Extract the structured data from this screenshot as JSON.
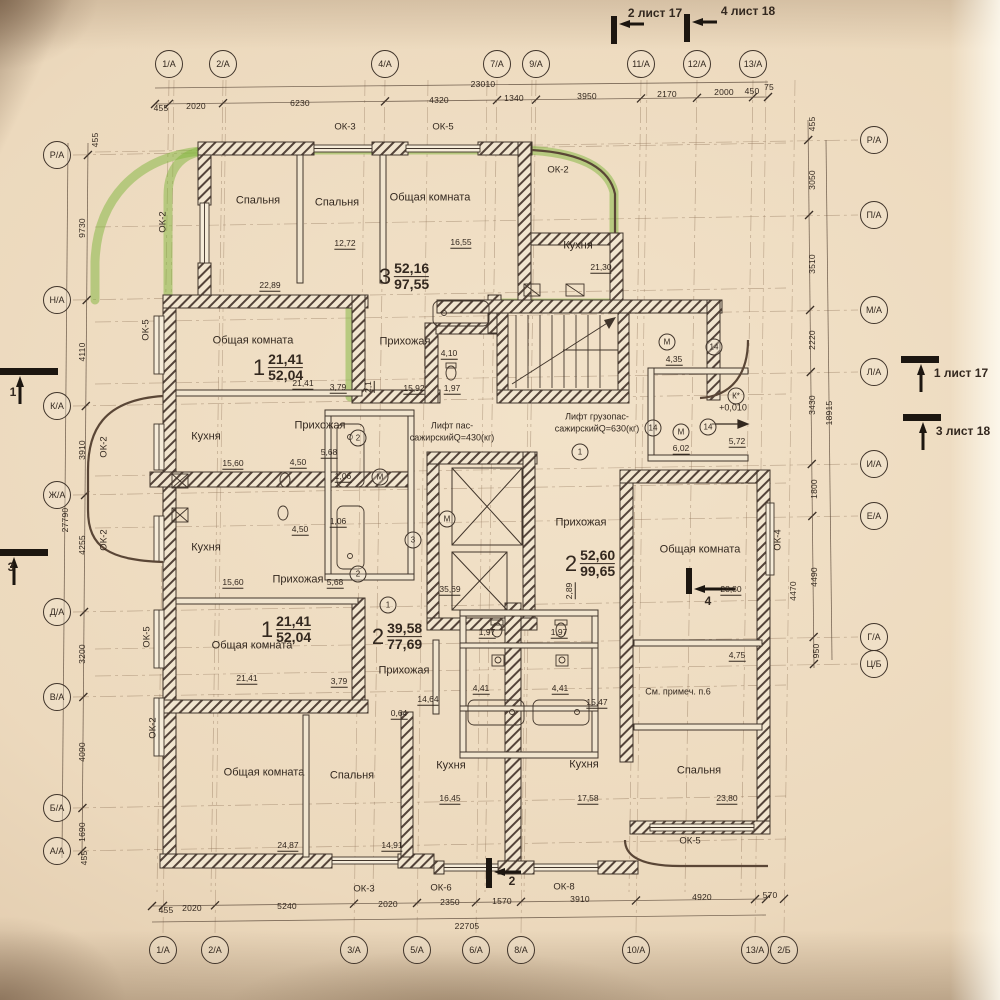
{
  "colors": {
    "paper": "#ecd9bf",
    "ink": "#3b2f26",
    "wall_hatch": "#54443a",
    "highlight_green": "#7fb63b"
  },
  "sheet_markers": {
    "top": [
      {
        "t": "2 лист 17",
        "x": 655,
        "y": 13
      },
      {
        "t": "4 лист 18",
        "x": 748,
        "y": 11
      }
    ],
    "right": [
      {
        "t": "1 лист 17",
        "x": 961,
        "y": 373
      },
      {
        "t": "3 лист 18",
        "x": 963,
        "y": 431
      }
    ],
    "left": [
      {
        "t": "1",
        "x": 13,
        "y": 392
      },
      {
        "t": "3",
        "x": 11,
        "y": 567
      }
    ],
    "bottom": [
      {
        "t": "2",
        "x": 512,
        "y": 881
      }
    ],
    "section": [
      {
        "t": "4",
        "x": 708,
        "y": 601
      }
    ]
  },
  "axes": {
    "top": [
      {
        "label": "1/А",
        "x": 169
      },
      {
        "label": "2/А",
        "x": 223
      },
      {
        "label": "4/А",
        "x": 385
      },
      {
        "label": "7/А",
        "x": 497
      },
      {
        "label": "9/А",
        "x": 536
      },
      {
        "label": "11/А",
        "x": 641
      },
      {
        "label": "12/А",
        "x": 697
      },
      {
        "label": "13/А",
        "x": 753
      }
    ],
    "bottom": [
      {
        "label": "1/А",
        "x": 163
      },
      {
        "label": "2/А",
        "x": 215
      },
      {
        "label": "3/А",
        "x": 354
      },
      {
        "label": "5/А",
        "x": 417
      },
      {
        "label": "6/А",
        "x": 476
      },
      {
        "label": "8/А",
        "x": 521
      },
      {
        "label": "10/А",
        "x": 636
      },
      {
        "label": "13/А",
        "x": 755
      },
      {
        "label": "2/Б",
        "x": 784
      }
    ],
    "left": [
      {
        "label": "Р/А",
        "y": 155
      },
      {
        "label": "Н/А",
        "y": 300
      },
      {
        "label": "К/А",
        "y": 406
      },
      {
        "label": "Ж/А",
        "y": 495
      },
      {
        "label": "Д/А",
        "y": 612
      },
      {
        "label": "В/А",
        "y": 697
      },
      {
        "label": "Б/А",
        "y": 808
      },
      {
        "label": "А/А",
        "y": 851
      }
    ],
    "right": [
      {
        "label": "Р/А",
        "y": 140
      },
      {
        "label": "П/А",
        "y": 215
      },
      {
        "label": "М/А",
        "y": 310
      },
      {
        "label": "Л/А",
        "y": 372
      },
      {
        "label": "И/А",
        "y": 464
      },
      {
        "label": "Е/А",
        "y": 516
      },
      {
        "label": "Г/А",
        "y": 637
      },
      {
        "label": "Ц/Б",
        "y": 664
      }
    ]
  },
  "dim_labels": [
    {
      "t": "455",
      "x": 161,
      "y": 108
    },
    {
      "t": "2020",
      "x": 196,
      "y": 106
    },
    {
      "t": "6230",
      "x": 300,
      "y": 103
    },
    {
      "t": "4320",
      "x": 439,
      "y": 100
    },
    {
      "t": "1340",
      "x": 514,
      "y": 98
    },
    {
      "t": "3950",
      "x": 587,
      "y": 96
    },
    {
      "t": "2170",
      "x": 667,
      "y": 94
    },
    {
      "t": "2000",
      "x": 724,
      "y": 92
    },
    {
      "t": "450",
      "x": 752,
      "y": 91
    },
    {
      "t": "75",
      "x": 769,
      "y": 87
    },
    {
      "t": "23010",
      "x": 483,
      "y": 84
    },
    {
      "t": "455",
      "x": 166,
      "y": 910
    },
    {
      "t": "2020",
      "x": 192,
      "y": 908
    },
    {
      "t": "5240",
      "x": 287,
      "y": 906
    },
    {
      "t": "2020",
      "x": 388,
      "y": 904
    },
    {
      "t": "2350",
      "x": 450,
      "y": 902
    },
    {
      "t": "1570",
      "x": 502,
      "y": 901
    },
    {
      "t": "3910",
      "x": 580,
      "y": 899
    },
    {
      "t": "4920",
      "x": 702,
      "y": 897
    },
    {
      "t": "570",
      "x": 770,
      "y": 895
    },
    {
      "t": "22705",
      "x": 467,
      "y": 926
    },
    {
      "t": "455",
      "x": 95,
      "y": 140,
      "r": 1
    },
    {
      "t": "9730",
      "x": 82,
      "y": 228,
      "r": 1
    },
    {
      "t": "4110",
      "x": 82,
      "y": 352,
      "r": 1
    },
    {
      "t": "3910",
      "x": 82,
      "y": 450,
      "r": 1
    },
    {
      "t": "27790",
      "x": 65,
      "y": 520,
      "r": 1
    },
    {
      "t": "4255",
      "x": 82,
      "y": 545,
      "r": 1
    },
    {
      "t": "3200",
      "x": 82,
      "y": 654,
      "r": 1
    },
    {
      "t": "4090",
      "x": 82,
      "y": 752,
      "r": 1
    },
    {
      "t": "1690",
      "x": 82,
      "y": 832,
      "r": 1
    },
    {
      "t": "455",
      "x": 84,
      "y": 858,
      "r": 1
    },
    {
      "t": "455",
      "x": 812,
      "y": 124,
      "r": 1
    },
    {
      "t": "3050",
      "x": 812,
      "y": 180,
      "r": 1
    },
    {
      "t": "3510",
      "x": 812,
      "y": 264,
      "r": 1
    },
    {
      "t": "2220",
      "x": 812,
      "y": 340,
      "r": 1
    },
    {
      "t": "3430",
      "x": 812,
      "y": 405,
      "r": 1
    },
    {
      "t": "18915",
      "x": 829,
      "y": 413,
      "r": 1
    },
    {
      "t": "1800",
      "x": 814,
      "y": 489,
      "r": 1
    },
    {
      "t": "4490",
      "x": 814,
      "y": 577,
      "r": 1
    },
    {
      "t": "950",
      "x": 816,
      "y": 651,
      "r": 1
    },
    {
      "t": "4470",
      "x": 793,
      "y": 591,
      "r": 1
    }
  ],
  "room_labels": [
    {
      "t": "Спальня",
      "x": 258,
      "y": 201
    },
    {
      "t": "Спальня",
      "x": 337,
      "y": 203
    },
    {
      "t": "Общая комната",
      "x": 430,
      "y": 198
    },
    {
      "t": "Кухня",
      "x": 578,
      "y": 246
    },
    {
      "t": "Общая комната",
      "x": 253,
      "y": 341
    },
    {
      "t": "Прихожая",
      "x": 405,
      "y": 342
    },
    {
      "t": "Кухня",
      "x": 206,
      "y": 437
    },
    {
      "t": "Прихожая",
      "x": 320,
      "y": 426
    },
    {
      "t": "Кухня",
      "x": 206,
      "y": 548
    },
    {
      "t": "Прихожая",
      "x": 298,
      "y": 580
    },
    {
      "t": "Общая комната",
      "x": 252,
      "y": 646
    },
    {
      "t": "Прихожая",
      "x": 404,
      "y": 671
    },
    {
      "t": "Прихожая",
      "x": 581,
      "y": 523
    },
    {
      "t": "Общая комната",
      "x": 700,
      "y": 550
    },
    {
      "t": "Общая комната",
      "x": 264,
      "y": 773
    },
    {
      "t": "Спальня",
      "x": 352,
      "y": 776
    },
    {
      "t": "Кухня",
      "x": 451,
      "y": 766
    },
    {
      "t": "Кухня",
      "x": 584,
      "y": 765
    },
    {
      "t": "Спальня",
      "x": 699,
      "y": 771
    }
  ],
  "area_labels": [
    {
      "t": "22,89",
      "x": 270,
      "y": 286
    },
    {
      "t": "12,72",
      "x": 345,
      "y": 244
    },
    {
      "t": "16,55",
      "x": 461,
      "y": 243
    },
    {
      "t": "21,30",
      "x": 601,
      "y": 268
    },
    {
      "t": "21,41",
      "x": 303,
      "y": 384
    },
    {
      "t": "3,79",
      "x": 338,
      "y": 388
    },
    {
      "t": "2,1",
      "x": 369,
      "y": 387,
      "r": 1
    },
    {
      "t": "4,10",
      "x": 449,
      "y": 354
    },
    {
      "t": "15,92",
      "x": 414,
      "y": 389
    },
    {
      "t": "1,97",
      "x": 452,
      "y": 389
    },
    {
      "t": "15,60",
      "x": 233,
      "y": 464
    },
    {
      "t": "4,50",
      "x": 298,
      "y": 463
    },
    {
      "t": "5,68",
      "x": 329,
      "y": 453
    },
    {
      "t": "1,06",
      "x": 343,
      "y": 477
    },
    {
      "t": "1,06",
      "x": 338,
      "y": 522
    },
    {
      "t": "4,50",
      "x": 300,
      "y": 530
    },
    {
      "t": "15,60",
      "x": 233,
      "y": 583
    },
    {
      "t": "5,68",
      "x": 335,
      "y": 583
    },
    {
      "t": "4,35",
      "x": 674,
      "y": 360
    },
    {
      "t": "6,02",
      "x": 681,
      "y": 449
    },
    {
      "t": "5,72",
      "x": 737,
      "y": 442
    },
    {
      "t": "35,69",
      "x": 450,
      "y": 590
    },
    {
      "t": "2,89",
      "x": 570,
      "y": 591,
      "r": 1
    },
    {
      "t": "28,80",
      "x": 731,
      "y": 590
    },
    {
      "t": "4,75",
      "x": 737,
      "y": 656
    },
    {
      "t": "21,41",
      "x": 247,
      "y": 679
    },
    {
      "t": "3,79",
      "x": 339,
      "y": 682
    },
    {
      "t": "14,64",
      "x": 428,
      "y": 700
    },
    {
      "t": "0,64",
      "x": 399,
      "y": 714
    },
    {
      "t": "1,97",
      "x": 487,
      "y": 633
    },
    {
      "t": "1,97",
      "x": 559,
      "y": 633
    },
    {
      "t": "4,41",
      "x": 481,
      "y": 689
    },
    {
      "t": "4,41",
      "x": 560,
      "y": 689
    },
    {
      "t": "15,47",
      "x": 597,
      "y": 703
    },
    {
      "t": "24,87",
      "x": 288,
      "y": 846
    },
    {
      "t": "14,91",
      "x": 392,
      "y": 846
    },
    {
      "t": "16,45",
      "x": 450,
      "y": 799
    },
    {
      "t": "17,58",
      "x": 588,
      "y": 799
    },
    {
      "t": "23,80",
      "x": 727,
      "y": 799
    }
  ],
  "window_labels": [
    {
      "t": "ОК-3",
      "x": 345,
      "y": 127
    },
    {
      "t": "ОК-5",
      "x": 443,
      "y": 127
    },
    {
      "t": "ОК-2",
      "x": 558,
      "y": 170
    },
    {
      "t": "ОК-2",
      "x": 163,
      "y": 222,
      "r": 1
    },
    {
      "t": "ОК-5",
      "x": 146,
      "y": 330,
      "r": 1
    },
    {
      "t": "ОК-2",
      "x": 104,
      "y": 447,
      "r": 1
    },
    {
      "t": "ОК-2",
      "x": 104,
      "y": 540,
      "r": 1
    },
    {
      "t": "ОК-5",
      "x": 147,
      "y": 637,
      "r": 1
    },
    {
      "t": "ОК-2",
      "x": 153,
      "y": 728,
      "r": 1
    },
    {
      "t": "ОК-4",
      "x": 778,
      "y": 540,
      "r": 1
    },
    {
      "t": "ОК-5",
      "x": 690,
      "y": 841
    },
    {
      "t": "ОК-3",
      "x": 364,
      "y": 889
    },
    {
      "t": "ОК-6",
      "x": 441,
      "y": 888
    },
    {
      "t": "ОК-8",
      "x": 564,
      "y": 887
    }
  ],
  "apartments": [
    {
      "number": "3",
      "living": "52,16",
      "total": "97,55",
      "x": 404,
      "y": 277
    },
    {
      "number": "1",
      "living": "21,41",
      "total": "52,04",
      "x": 278,
      "y": 368
    },
    {
      "number": "1",
      "living": "21,41",
      "total": "52,04",
      "x": 286,
      "y": 630
    },
    {
      "number": "2",
      "living": "39,58",
      "total": "77,69",
      "x": 397,
      "y": 637
    },
    {
      "number": "2",
      "living": "52,60",
      "total": "99,65",
      "x": 590,
      "y": 564
    }
  ],
  "elevators": [
    {
      "line1": "Лифт пас-",
      "line2": "сажирскийQ=430(кг)",
      "x": 452,
      "y": 432
    },
    {
      "line1": "Лифт грузопас-",
      "line2": "сажирскийQ=630(кг)",
      "x": 597,
      "y": 423
    }
  ],
  "circled_marks": [
    {
      "t": "М",
      "x": 380,
      "y": 477
    },
    {
      "t": "М",
      "x": 447,
      "y": 519
    },
    {
      "t": "М",
      "x": 667,
      "y": 342
    },
    {
      "t": "М",
      "x": 681,
      "y": 432
    },
    {
      "t": "14",
      "x": 714,
      "y": 347
    },
    {
      "t": "14",
      "x": 653,
      "y": 428
    },
    {
      "t": "14",
      "x": 708,
      "y": 427
    },
    {
      "t": "К*",
      "x": 736,
      "y": 396
    },
    {
      "t": "1",
      "x": 580,
      "y": 452
    },
    {
      "t": "1",
      "x": 388,
      "y": 605
    },
    {
      "t": "3",
      "x": 413,
      "y": 540
    },
    {
      "t": "2",
      "x": 358,
      "y": 438
    },
    {
      "t": "2",
      "x": 358,
      "y": 574
    }
  ],
  "notes": [
    {
      "t": "См. примеч. п.6",
      "x": 678,
      "y": 692
    },
    {
      "t": "+0,010",
      "x": 733,
      "y": 408
    }
  ]
}
